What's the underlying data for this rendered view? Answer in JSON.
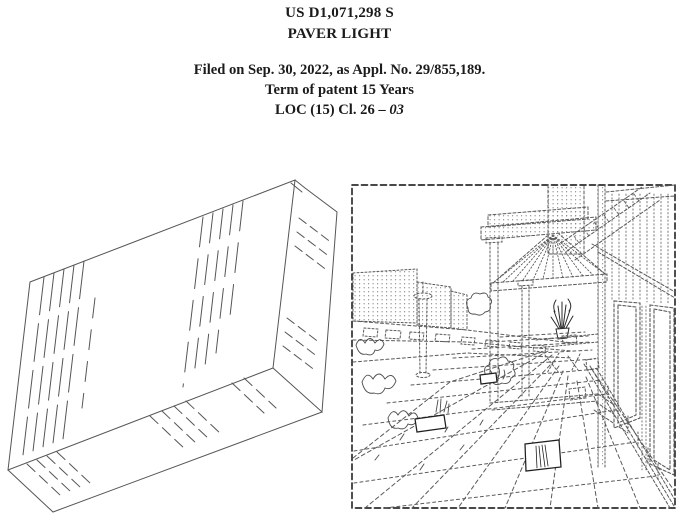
{
  "colors": {
    "ink": "#1b1b1b",
    "line": "#555555",
    "border": "#2f2f2f",
    "tile": "#1f1f1f"
  },
  "header": {
    "patent_number": "US D1,071,298 S",
    "title": "PAVER LIGHT",
    "filed_line": "Filed on Sep. 30, 2022, as Appl. No. 29/855,189.",
    "term_line": "Term of patent 15 Years",
    "loc_prefix": "LOC (15) Cl. 26 ",
    "loc_dash": "–",
    "loc_class": "03"
  },
  "figures": {
    "left_name": "paver-light-perspective-drawing",
    "right_name": "walkway-environment-drawing"
  }
}
